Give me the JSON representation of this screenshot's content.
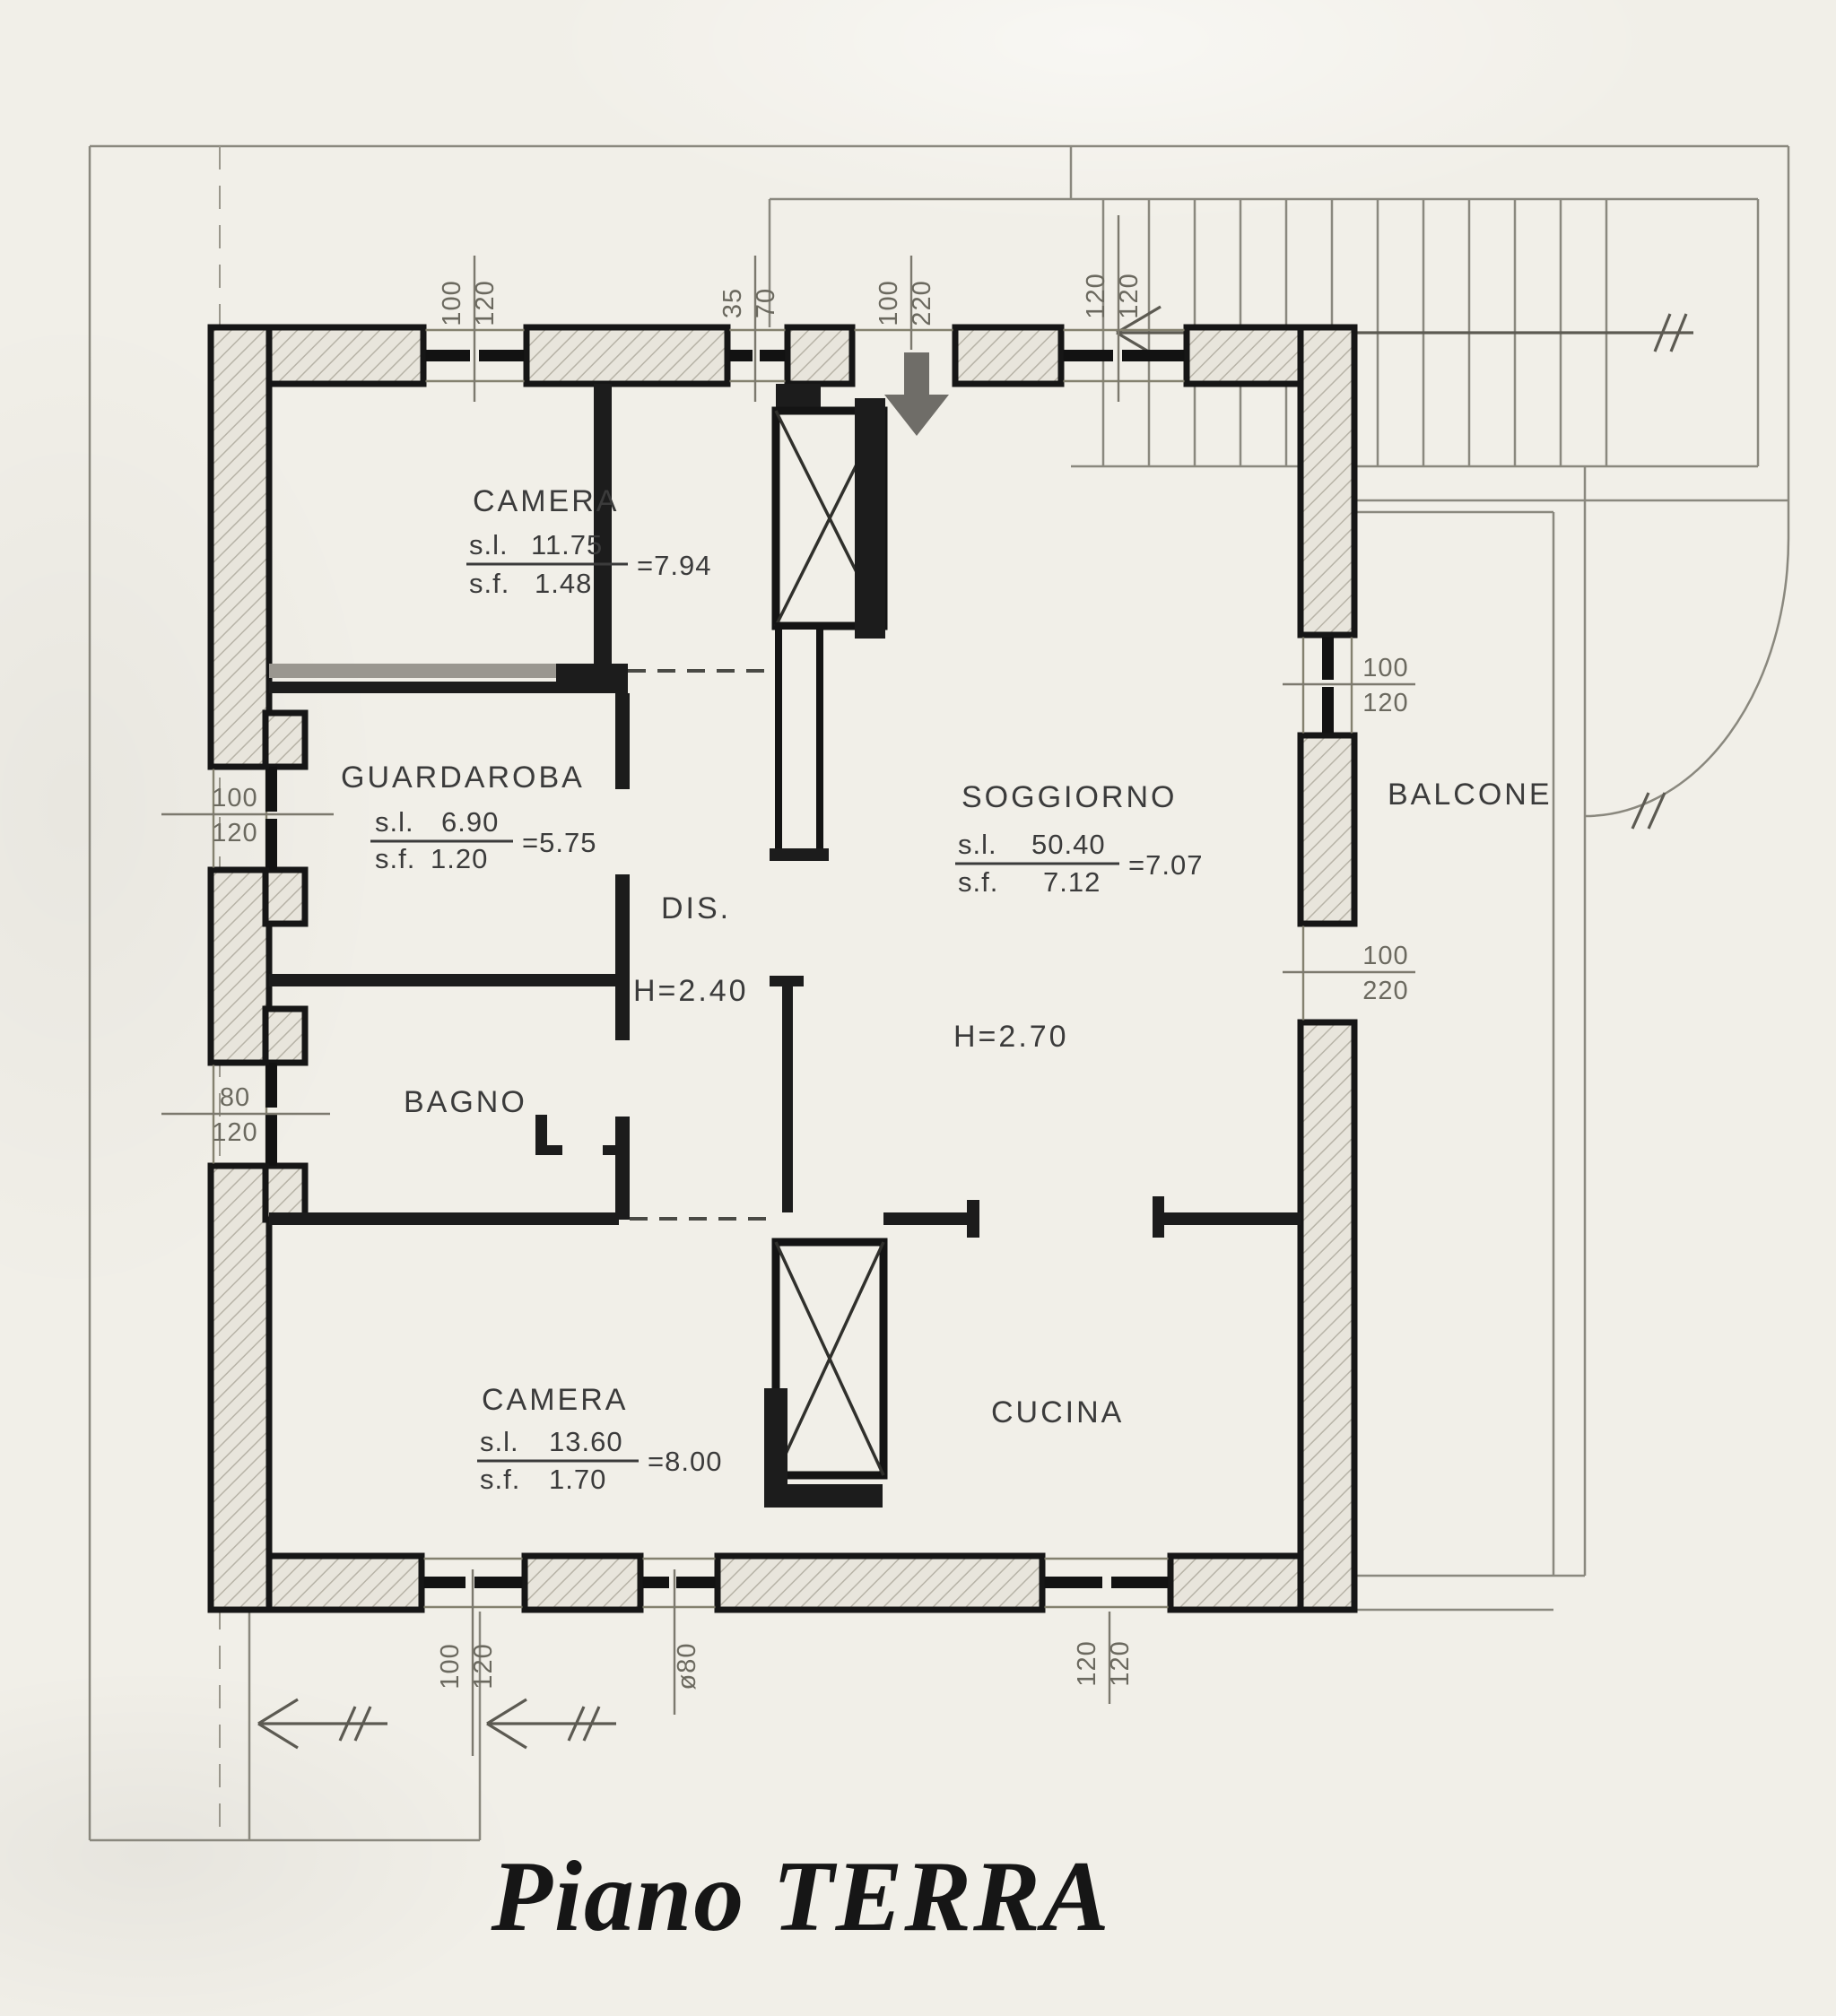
{
  "title": "Piano TERRA",
  "rooms": {
    "camera1": {
      "name": "CAMERA",
      "sl_label": "s.l.",
      "sl_value": "11.75",
      "sf_label": "s.f.",
      "sf_value": "1.48",
      "eq": "=7.94"
    },
    "guardaroba": {
      "name": "GUARDAROBA",
      "sl_label": "s.l.",
      "sl_value": "6.90",
      "sf_label": "s.f.",
      "sf_value": "1.20",
      "eq": "=5.75"
    },
    "dis": {
      "name": "DIS.",
      "height": "H=2.40"
    },
    "bagno": {
      "name": "BAGNO"
    },
    "soggiorno": {
      "name": "SOGGIORNO",
      "sl_label": "s.l.",
      "sl_value": "50.40",
      "sf_label": "s.f.",
      "sf_value": "7.12",
      "eq": "=7.07",
      "height": "H=2.70"
    },
    "balcone": {
      "name": "BALCONE"
    },
    "camera2": {
      "name": "CAMERA",
      "sl_label": "s.l.",
      "sl_value": "13.60",
      "sf_label": "s.f.",
      "sf_value": "1.70",
      "eq": "=8.00"
    },
    "cucina": {
      "name": "CUCINA"
    }
  },
  "dims": {
    "top": [
      {
        "num": "100",
        "den": "120"
      },
      {
        "num": "35",
        "den": "70"
      },
      {
        "num": "100",
        "den": "220"
      },
      {
        "num": "120",
        "den": "120"
      }
    ],
    "bottom": [
      {
        "num": "100",
        "den": "120"
      },
      {
        "num": "ø80",
        "den": ""
      },
      {
        "num": "120",
        "den": "120"
      }
    ],
    "left": [
      {
        "num": "100",
        "den": "120"
      },
      {
        "num": "80",
        "den": "120"
      }
    ],
    "right": [
      {
        "num": "100",
        "den": "120"
      },
      {
        "num": "100",
        "den": "220"
      }
    ]
  }
}
